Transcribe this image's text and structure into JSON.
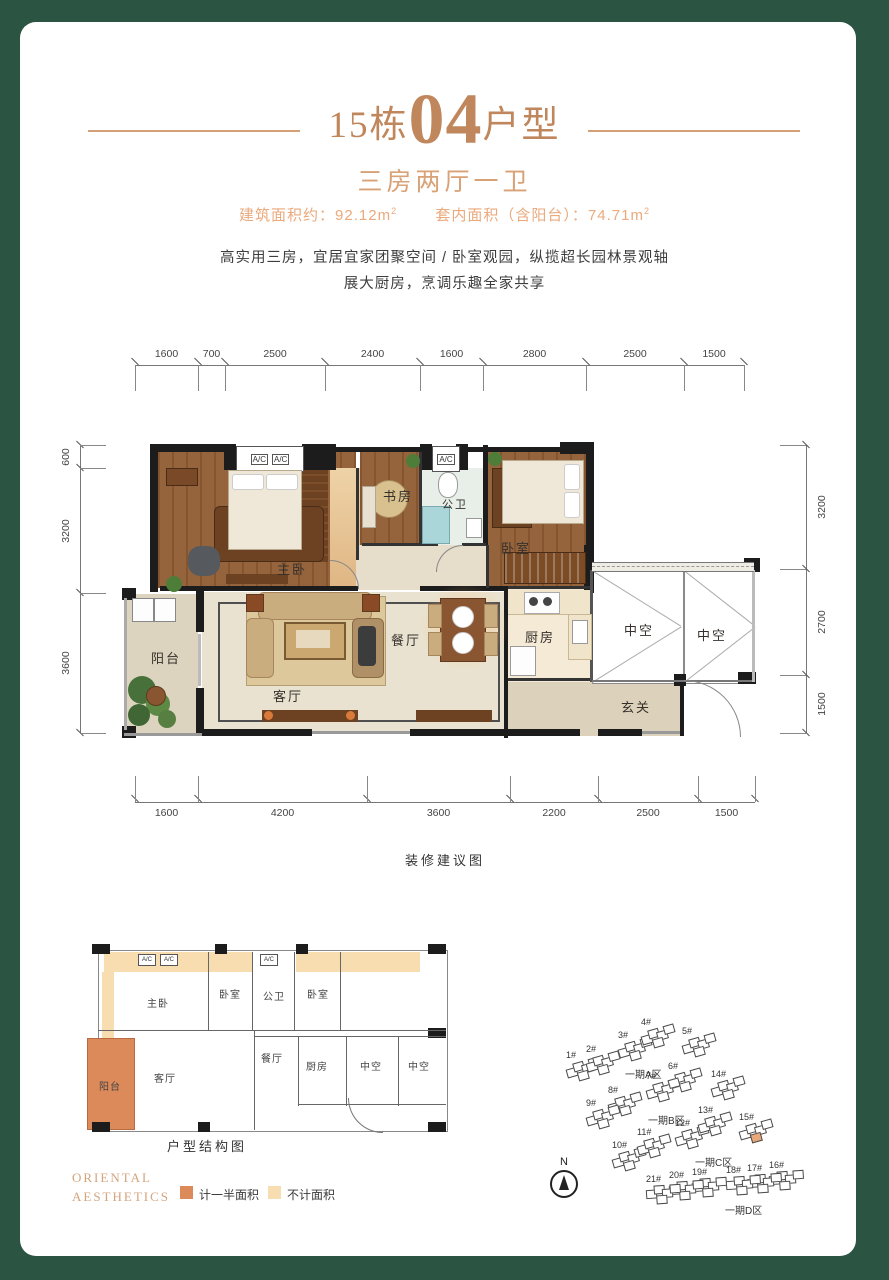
{
  "page": {
    "title": {
      "block": "15栋",
      "unit": "04",
      "suffix": "户型"
    },
    "subtitle": "三房两厅一卫",
    "area": {
      "build_label": "建筑面积约：",
      "build_value": "92.12",
      "inner_label": "套内面积（含阳台）：",
      "inner_value": "74.71",
      "unit": "m",
      "sup": "2"
    },
    "desc_line1": "高实用三房，宜居宜家团聚空间 / 卧室观园，纵揽超长园林景观轴",
    "desc_line2": "展大厨房，烹调乐趣全家共享"
  },
  "main_plan": {
    "caption": "装修建议图",
    "ac_label": "A/C",
    "dims_top": [
      "1600",
      "700",
      "2500",
      "2400",
      "1600",
      "2800",
      "2500",
      "1500"
    ],
    "dims_bottom": [
      "1600",
      "4200",
      "3600",
      "2200",
      "2500",
      "1500"
    ],
    "dims_left": [
      "600",
      "3200",
      "3600"
    ],
    "dims_right": [
      "3200",
      "2700",
      "1500"
    ],
    "rooms": {
      "master": "主卧",
      "study": "书房",
      "bath": "公卫",
      "bedroom": "卧室",
      "balcony": "阳台",
      "living": "客厅",
      "dining": "餐厅",
      "kitchen": "厨房",
      "void": "中空",
      "foyer": "玄关"
    }
  },
  "structure_plan": {
    "caption": "户型结构图",
    "unit_badge": "04",
    "ac_label": "A/C",
    "rooms": {
      "master": "主卧",
      "bedroom": "卧室",
      "bath": "公卫",
      "bedroom2": "卧室",
      "dining": "餐厅",
      "kitchen": "厨房",
      "void": "中空",
      "void2": "中空",
      "living": "客厅",
      "balcony": "阳台"
    }
  },
  "legend": {
    "half_label": "计一半面积",
    "half_color": "#dd8a5b",
    "none_label": "不计面积",
    "none_color": "#f8ddb0"
  },
  "brand": {
    "line1": "ORIENTAL",
    "line2": "AESTHETICS"
  },
  "site_plan": {
    "north_label": "N",
    "zones": [
      {
        "label": "一期A区",
        "x": 625,
        "y": 1066
      },
      {
        "label": "一期B区",
        "x": 648,
        "y": 1112
      },
      {
        "label": "一期C区",
        "x": 695,
        "y": 1154
      },
      {
        "label": "一期D区",
        "x": 725,
        "y": 1202
      }
    ],
    "buildings": [
      {
        "label": "1#",
        "x": 566,
        "y": 1050,
        "highlight": false
      },
      {
        "label": "2#",
        "x": 586,
        "y": 1044,
        "highlight": false
      },
      {
        "label": "3#",
        "x": 618,
        "y": 1030,
        "highlight": false
      },
      {
        "label": "4#",
        "x": 641,
        "y": 1017,
        "highlight": false
      },
      {
        "label": "5#",
        "x": 682,
        "y": 1026,
        "highlight": false
      },
      {
        "label": "6#",
        "x": 668,
        "y": 1061,
        "highlight": false
      },
      {
        "label": "7#",
        "x": 646,
        "y": 1071,
        "highlight": false
      },
      {
        "label": "8#",
        "x": 608,
        "y": 1085,
        "highlight": false
      },
      {
        "label": "9#",
        "x": 586,
        "y": 1098,
        "highlight": false
      },
      {
        "label": "10#",
        "x": 612,
        "y": 1140,
        "highlight": false
      },
      {
        "label": "11#",
        "x": 637,
        "y": 1127,
        "highlight": false
      },
      {
        "label": "12#",
        "x": 675,
        "y": 1118,
        "highlight": false
      },
      {
        "label": "13#",
        "x": 698,
        "y": 1105,
        "highlight": false
      },
      {
        "label": "14#",
        "x": 711,
        "y": 1069,
        "highlight": false
      },
      {
        "label": "15#",
        "x": 739,
        "y": 1112,
        "highlight": true
      },
      {
        "label": "16#",
        "x": 769,
        "y": 1160,
        "highlight": false
      },
      {
        "label": "17#",
        "x": 747,
        "y": 1163,
        "highlight": false
      },
      {
        "label": "18#",
        "x": 726,
        "y": 1165,
        "highlight": false
      },
      {
        "label": "19#",
        "x": 692,
        "y": 1167,
        "highlight": false
      },
      {
        "label": "20#",
        "x": 669,
        "y": 1170,
        "highlight": false
      },
      {
        "label": "21#",
        "x": 646,
        "y": 1174,
        "highlight": false
      }
    ]
  },
  "colors": {
    "frame_green": "#2b5443",
    "accent_tan": "#c0875c",
    "accent_light": "#eba97c",
    "highlight_building": "#e8a87c"
  }
}
